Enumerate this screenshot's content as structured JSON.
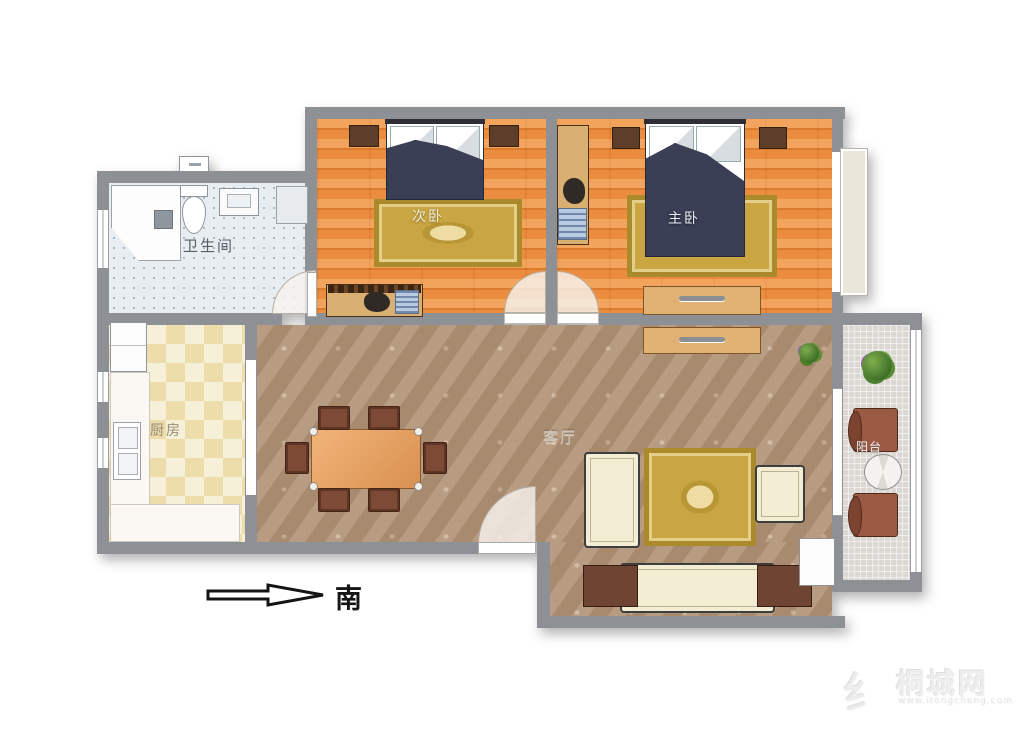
{
  "rooms": {
    "bathroom": {
      "label": "卫生间"
    },
    "second_bedroom": {
      "label": "次卧"
    },
    "master_bedroom": {
      "label": "主卧"
    },
    "kitchen": {
      "label": "厨房"
    },
    "living_room": {
      "label": "客厅"
    },
    "balcony": {
      "label": "阳台"
    }
  },
  "compass": {
    "label": "南"
  },
  "watermark": {
    "logo_glyph": "纟",
    "site_name": "桐城网",
    "site_url": "www.itongcheng.com"
  },
  "colors": {
    "wall": "#8d9095",
    "bedroom_wood_floor": "#ec8c3e",
    "living_marble_floor": "#b29478",
    "kitchen_checker_floor": "#efe2b4",
    "bathroom_tile_floor": "#e8edf1",
    "balcony_tile_floor": "#dbd8d3",
    "rug_gold": "#c9a642",
    "bed_duvet_navy": "#3a3f55",
    "sofa_cream": "#f3edd3",
    "furniture_brown": "#6e4532",
    "dining_table_tan": "#e2a35f"
  }
}
